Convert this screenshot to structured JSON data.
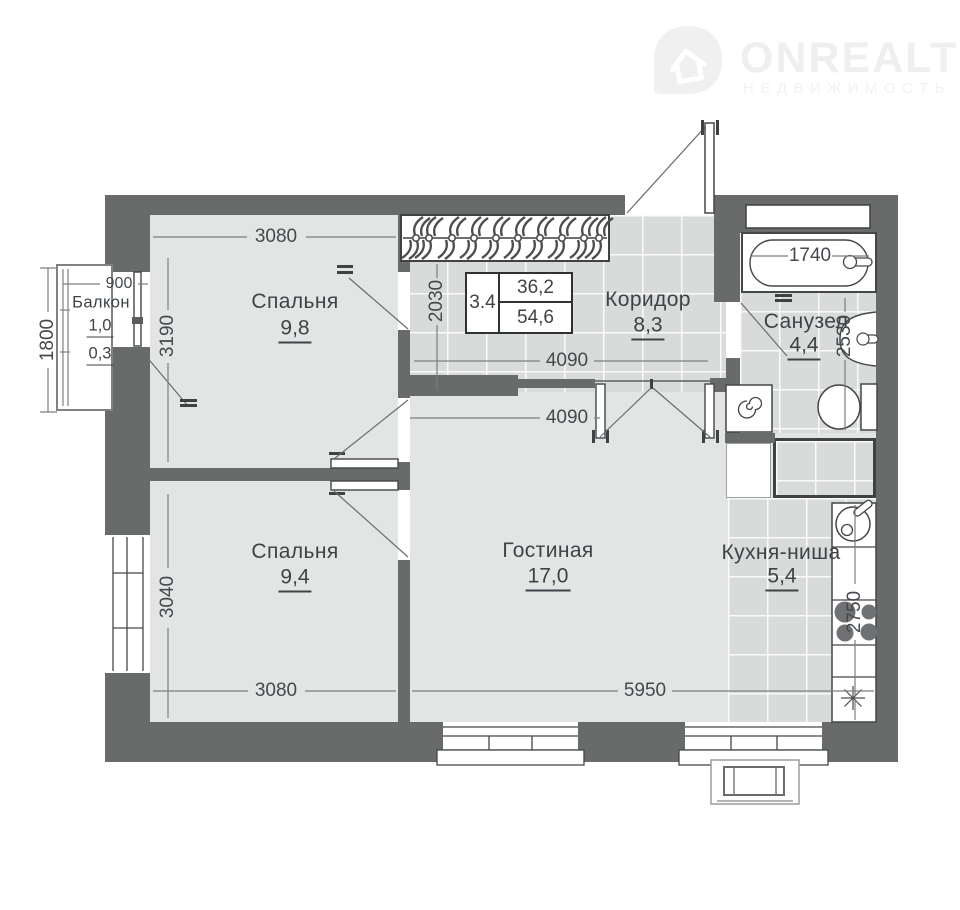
{
  "logo": {
    "brand": "ONREALT",
    "tagline": "НЕДВИЖИМОСТЬ"
  },
  "summary": {
    "left": "3.4",
    "top": "36,2",
    "bottom": "54,6"
  },
  "rooms": {
    "balcony": {
      "name": "Балкон",
      "area_full": "1,0",
      "area_reduced": "0,3"
    },
    "bedroom1": {
      "name": "Спальня",
      "area": "9,8"
    },
    "bedroom2": {
      "name": "Спальня",
      "area": "9,4"
    },
    "living_room": {
      "name": "Гостиная",
      "area": "17,0"
    },
    "corridor": {
      "name": "Коридор",
      "area": "8,3"
    },
    "bathroom": {
      "name": "Санузел",
      "area": "4,4"
    },
    "kitchen_niche": {
      "name": "Кухня-ниша",
      "area": "5,4"
    }
  },
  "dimensions_mm": {
    "balcony_width": "900",
    "balcony_depth": "1800",
    "bedroom1_width": "3080",
    "bedroom1_depth": "3190",
    "hall_depth": "2030",
    "corridor_width": "4090",
    "living_width": "4090",
    "living_bottom_width": "5950",
    "bedroom2_width": "3080",
    "bedroom2_depth": "3040",
    "bathtub_length": "1740",
    "bathroom_depth": "2530",
    "kitchen_counter_length": "2750"
  }
}
